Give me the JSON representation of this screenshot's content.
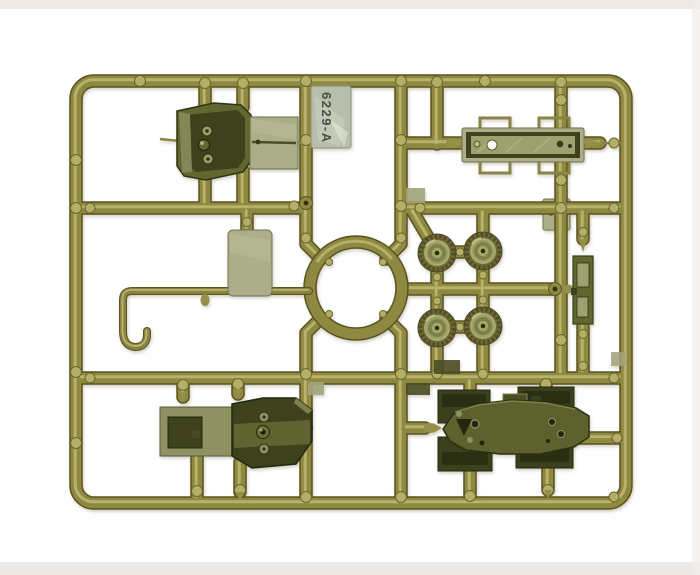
{
  "photo": {
    "subject": "olive-drab injection-molded model kit sprue on white background",
    "part_number_label": "6229-A",
    "colors": {
      "background": "#ffffff",
      "photo_edge": "#e8e6e3",
      "runner_dark": "#5a5420",
      "runner_mid": "#8e8840",
      "runner_highlight": "#c6c07a",
      "bump": "#b4ae66",
      "gate": "#968f4a",
      "part_dark": "#2f3414",
      "part_deep": "#3d421d",
      "part_mid": "#62662f",
      "part_light": "#9b9e74",
      "plate_light": "#acae8a",
      "plate_face": "#9da06f",
      "tag_fill": "#b7bdac",
      "tag_text": "#4a4f40",
      "wheel_rim": "#6e6933",
      "wheel_teeth": "#524e27",
      "wheel_face": "#9da063",
      "wheel_dish": "#7d8148",
      "hole_dark": "#2c3013"
    },
    "parts": [
      {
        "name": "hull-front-section"
      },
      {
        "name": "part-number-tag"
      },
      {
        "name": "fender-plate"
      },
      {
        "name": "road-wheel",
        "count": 4
      },
      {
        "name": "exhaust-bar"
      },
      {
        "name": "small-plate"
      },
      {
        "name": "rectangular-plate"
      },
      {
        "name": "tow-hook-rod"
      },
      {
        "name": "hull-rear-section"
      },
      {
        "name": "vehicle-chassis"
      }
    ]
  }
}
